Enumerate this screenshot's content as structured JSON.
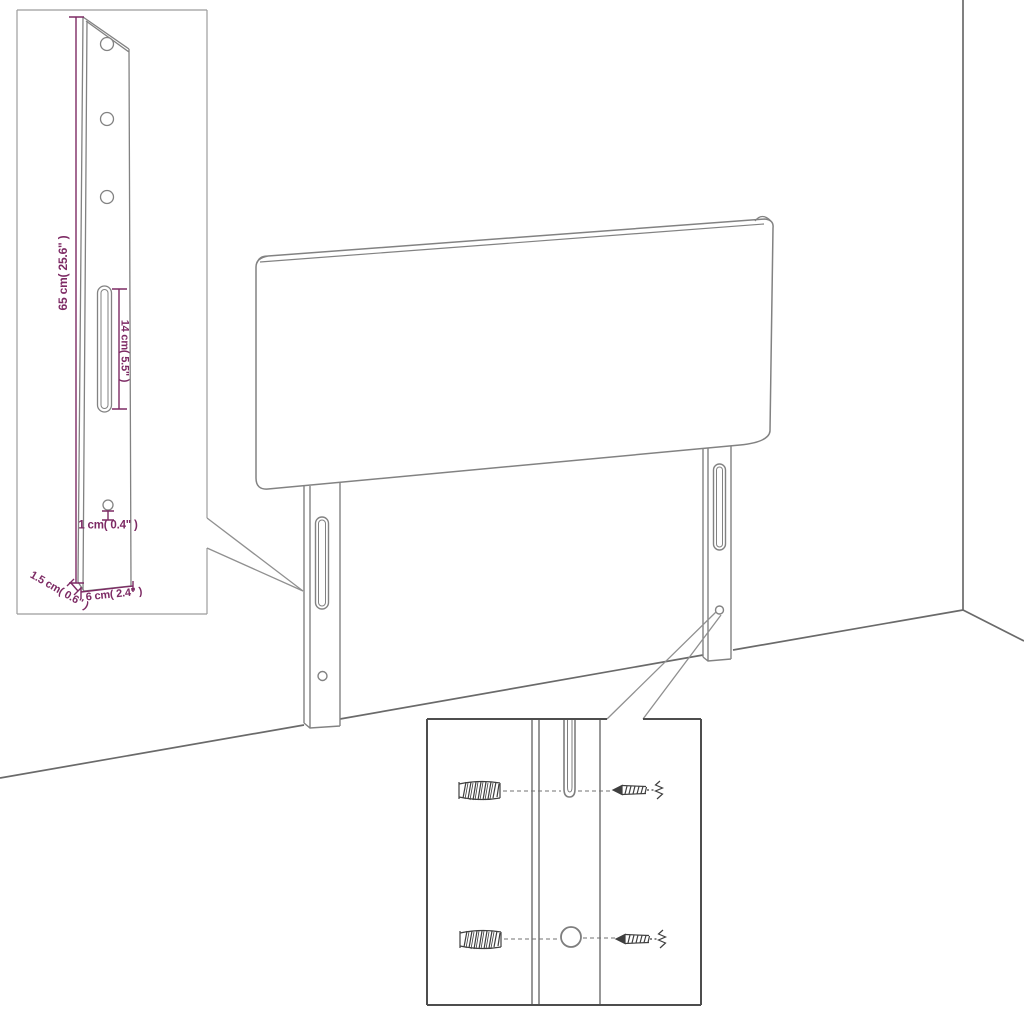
{
  "figure": {
    "type": "furniture-assembly-dimension-diagram",
    "subject": "headboard with two mounting legs, leg detail inset and wall-fixing hardware inset"
  },
  "colors": {
    "background": "#ffffff",
    "dimension_text": "#7d2a64",
    "drawing_line": "#828282",
    "wall_line": "#6a6a6a",
    "detail_box_border": "#9c9c9c",
    "inset_box_border": "#4d4d4d",
    "hardware_line": "#3f3f3f"
  },
  "detail_inset": {
    "dimensions": {
      "bar_height": "65 cm( 25.6\" )",
      "slot_length": "14 cm( 5.5\" )",
      "hole_diameter": "1 cm( 0.4\" )",
      "bar_thickness": "1.5 cm( 0.6\" )",
      "bar_width": "6 cm( 2.4\" )"
    }
  }
}
